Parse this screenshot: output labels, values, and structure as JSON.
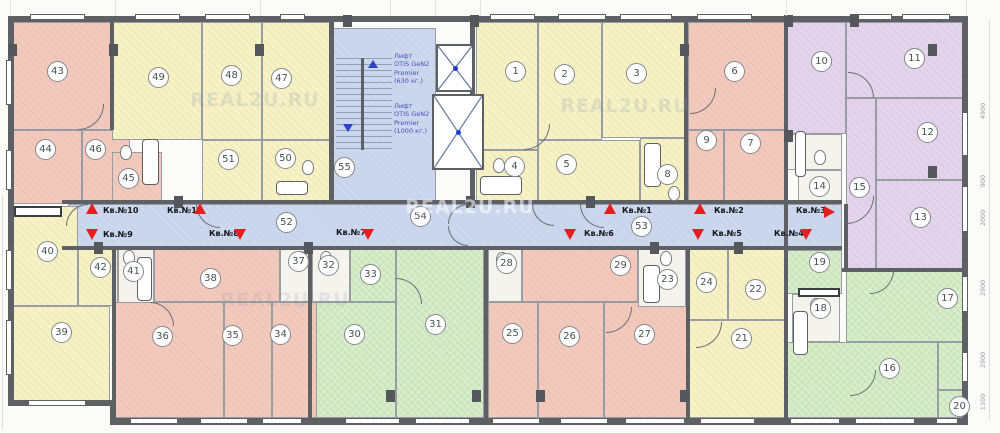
{
  "plan": {
    "width": 1000,
    "height": 433,
    "watermark_text": "REAL2U.RU",
    "colors": {
      "pink": "#f2cabd",
      "yellow": "#f6f2c6",
      "green": "#d9edcb",
      "purple": "#e3d4ec",
      "corridor_blue": "#ccd7ee",
      "bath_white": "#f4f3ec",
      "wall_gray": "#5d6166",
      "arrow_red": "#e31f1f",
      "elevator_text_blue": "#4353b8"
    },
    "rooms": [
      {
        "n": "",
        "x": 68,
        "y": 204,
        "w": 774,
        "h": 46,
        "zone": "corridor"
      },
      {
        "n": "43",
        "x": 12,
        "y": 22,
        "w": 100,
        "h": 108,
        "zone": "pink",
        "lx": 58,
        "ly": 72
      },
      {
        "n": "44",
        "x": 12,
        "y": 130,
        "w": 70,
        "h": 74,
        "zone": "pink",
        "lx": 46,
        "ly": 150
      },
      {
        "n": "46",
        "x": 82,
        "y": 130,
        "w": 48,
        "h": 74,
        "zone": "pink",
        "lx": 96,
        "ly": 150
      },
      {
        "n": "45",
        "x": 112,
        "y": 152,
        "w": 50,
        "h": 52,
        "zone": "pink",
        "lx": 129,
        "ly": 179
      },
      {
        "n": "49",
        "x": 112,
        "y": 22,
        "w": 90,
        "h": 118,
        "zone": "yellow",
        "lx": 159,
        "ly": 78
      },
      {
        "n": "48",
        "x": 202,
        "y": 22,
        "w": 60,
        "h": 118,
        "zone": "yellow",
        "lx": 232,
        "ly": 76
      },
      {
        "n": "47",
        "x": 262,
        "y": 22,
        "w": 68,
        "h": 118,
        "zone": "yellow",
        "lx": 282,
        "ly": 79
      },
      {
        "n": "51",
        "x": 202,
        "y": 140,
        "w": 60,
        "h": 64,
        "zone": "yellow",
        "lx": 229,
        "ly": 160
      },
      {
        "n": "50",
        "x": 262,
        "y": 140,
        "w": 68,
        "h": 64,
        "zone": "yellow",
        "lx": 286,
        "ly": 159
      },
      {
        "n": "55",
        "x": 332,
        "y": 28,
        "w": 104,
        "h": 176,
        "zone": "stair",
        "lx": 345,
        "ly": 168
      },
      {
        "n": "1",
        "x": 476,
        "y": 22,
        "w": 62,
        "h": 128,
        "zone": "yellow",
        "lx": 516,
        "ly": 72
      },
      {
        "n": "2",
        "x": 538,
        "y": 22,
        "w": 64,
        "h": 118,
        "zone": "yellow",
        "lx": 565,
        "ly": 75
      },
      {
        "n": "3",
        "x": 602,
        "y": 22,
        "w": 86,
        "h": 116,
        "zone": "yellow",
        "lx": 637,
        "ly": 74
      },
      {
        "n": "4",
        "x": 476,
        "y": 150,
        "w": 62,
        "h": 54,
        "zone": "yellow",
        "lx": 515,
        "ly": 167
      },
      {
        "n": "5",
        "x": 538,
        "y": 140,
        "w": 102,
        "h": 64,
        "zone": "yellow",
        "lx": 567,
        "ly": 165
      },
      {
        "n": "8",
        "x": 640,
        "y": 138,
        "w": 46,
        "h": 66,
        "zone": "yellow",
        "lx": 668,
        "ly": 175
      },
      {
        "n": "6",
        "x": 688,
        "y": 22,
        "w": 98,
        "h": 108,
        "zone": "pink",
        "lx": 735,
        "ly": 72
      },
      {
        "n": "9",
        "x": 688,
        "y": 130,
        "w": 36,
        "h": 74,
        "zone": "pink",
        "lx": 707,
        "ly": 141
      },
      {
        "n": "7",
        "x": 724,
        "y": 130,
        "w": 62,
        "h": 74,
        "zone": "pink",
        "lx": 751,
        "ly": 144
      },
      {
        "n": "10",
        "x": 786,
        "y": 22,
        "w": 60,
        "h": 112,
        "zone": "purple",
        "lx": 822,
        "ly": 62
      },
      {
        "n": "11",
        "x": 846,
        "y": 22,
        "w": 118,
        "h": 76,
        "zone": "purple",
        "lx": 915,
        "ly": 59
      },
      {
        "n": "12",
        "x": 876,
        "y": 98,
        "w": 88,
        "h": 82,
        "zone": "purple",
        "lx": 928,
        "ly": 133
      },
      {
        "n": "15",
        "x": 846,
        "y": 98,
        "w": 30,
        "h": 172,
        "zone": "purple",
        "lx": 860,
        "ly": 188
      },
      {
        "n": "13",
        "x": 876,
        "y": 180,
        "w": 88,
        "h": 90,
        "zone": "purple",
        "lx": 921,
        "ly": 218
      },
      {
        "n": "14",
        "x": 798,
        "y": 170,
        "w": 44,
        "h": 34,
        "zone": "bath",
        "lx": 820,
        "ly": 187
      },
      {
        "n": "",
        "x": 786,
        "y": 134,
        "w": 56,
        "h": 36,
        "zone": "bath"
      },
      {
        "n": "19",
        "x": 786,
        "y": 250,
        "w": 56,
        "h": 44,
        "zone": "green",
        "lx": 820,
        "ly": 263
      },
      {
        "n": "18",
        "x": 792,
        "y": 294,
        "w": 48,
        "h": 48,
        "zone": "bath",
        "lx": 821,
        "ly": 309
      },
      {
        "n": "17",
        "x": 846,
        "y": 270,
        "w": 118,
        "h": 72,
        "zone": "green",
        "lx": 948,
        "ly": 299
      },
      {
        "n": "16",
        "x": 786,
        "y": 342,
        "w": 152,
        "h": 76,
        "zone": "green",
        "lx": 890,
        "ly": 369
      },
      {
        "n": "20",
        "x": 938,
        "y": 390,
        "w": 26,
        "h": 28,
        "zone": "green",
        "lx": 960,
        "ly": 407
      },
      {
        "n": "",
        "x": 938,
        "y": 342,
        "w": 26,
        "h": 48,
        "zone": "green"
      },
      {
        "n": "40",
        "x": 12,
        "y": 206,
        "w": 66,
        "h": 100,
        "zone": "yellow",
        "lx": 48,
        "ly": 252
      },
      {
        "n": "39",
        "x": 12,
        "y": 306,
        "w": 98,
        "h": 96,
        "zone": "yellow",
        "lx": 62,
        "ly": 333
      },
      {
        "n": "42",
        "x": 78,
        "y": 247,
        "w": 40,
        "h": 59,
        "zone": "yellow",
        "lx": 101,
        "ly": 268
      },
      {
        "n": "41",
        "x": 118,
        "y": 247,
        "w": 36,
        "h": 59,
        "zone": "bath",
        "lx": 134,
        "ly": 272
      },
      {
        "n": "38",
        "x": 154,
        "y": 247,
        "w": 126,
        "h": 55,
        "zone": "pink",
        "lx": 211,
        "ly": 279
      },
      {
        "n": "37",
        "x": 280,
        "y": 247,
        "w": 32,
        "h": 55,
        "zone": "bath",
        "lx": 299,
        "ly": 262
      },
      {
        "n": "36",
        "x": 114,
        "y": 302,
        "w": 110,
        "h": 116,
        "zone": "pink",
        "lx": 163,
        "ly": 337
      },
      {
        "n": "35",
        "x": 224,
        "y": 302,
        "w": 48,
        "h": 116,
        "zone": "pink",
        "lx": 233,
        "ly": 336
      },
      {
        "n": "34",
        "x": 272,
        "y": 302,
        "w": 58,
        "h": 116,
        "zone": "pink",
        "lx": 281,
        "ly": 335
      },
      {
        "n": "32",
        "x": 312,
        "y": 247,
        "w": 38,
        "h": 55,
        "zone": "bath",
        "lx": 329,
        "ly": 266
      },
      {
        "n": "33",
        "x": 350,
        "y": 247,
        "w": 46,
        "h": 55,
        "zone": "green",
        "lx": 371,
        "ly": 275
      },
      {
        "n": "30",
        "x": 316,
        "y": 302,
        "w": 80,
        "h": 116,
        "zone": "green",
        "lx": 355,
        "ly": 335
      },
      {
        "n": "31",
        "x": 396,
        "y": 247,
        "w": 88,
        "h": 171,
        "zone": "green",
        "lx": 436,
        "ly": 325
      },
      {
        "n": "28",
        "x": 488,
        "y": 247,
        "w": 34,
        "h": 55,
        "zone": "bath",
        "lx": 507,
        "ly": 264
      },
      {
        "n": "29",
        "x": 522,
        "y": 247,
        "w": 116,
        "h": 55,
        "zone": "pink",
        "lx": 621,
        "ly": 266
      },
      {
        "n": "25",
        "x": 488,
        "y": 302,
        "w": 50,
        "h": 116,
        "zone": "pink",
        "lx": 513,
        "ly": 334
      },
      {
        "n": "26",
        "x": 538,
        "y": 302,
        "w": 66,
        "h": 116,
        "zone": "pink",
        "lx": 570,
        "ly": 337
      },
      {
        "n": "27",
        "x": 604,
        "y": 302,
        "w": 84,
        "h": 116,
        "zone": "pink",
        "lx": 645,
        "ly": 335
      },
      {
        "n": "23",
        "x": 638,
        "y": 247,
        "w": 48,
        "h": 60,
        "zone": "bath",
        "lx": 668,
        "ly": 280
      },
      {
        "n": "24",
        "x": 686,
        "y": 247,
        "w": 42,
        "h": 73,
        "zone": "yellow",
        "lx": 707,
        "ly": 283
      },
      {
        "n": "22",
        "x": 728,
        "y": 247,
        "w": 60,
        "h": 73,
        "zone": "yellow",
        "lx": 756,
        "ly": 290
      },
      {
        "n": "21",
        "x": 688,
        "y": 320,
        "w": 100,
        "h": 98,
        "zone": "yellow",
        "lx": 742,
        "ly": 339
      }
    ],
    "extra_badges": [
      {
        "n": "52",
        "lx": 287,
        "ly": 223
      },
      {
        "n": "54",
        "lx": 421,
        "ly": 217
      },
      {
        "n": "53",
        "lx": 642,
        "ly": 227
      }
    ],
    "corridor_labels": [
      {
        "t": "Кв.№10",
        "x": 103,
        "y": 206
      },
      {
        "t": "Кв.№11",
        "x": 167,
        "y": 206
      },
      {
        "t": "Кв.№9",
        "x": 103,
        "y": 230
      },
      {
        "t": "Кв.№8",
        "x": 209,
        "y": 229
      },
      {
        "t": "Кв.№7",
        "x": 336,
        "y": 228
      },
      {
        "t": "Кв.№1",
        "x": 622,
        "y": 206
      },
      {
        "t": "Кв.№6",
        "x": 584,
        "y": 229
      },
      {
        "t": "Кв.№2",
        "x": 714,
        "y": 206
      },
      {
        "t": "Кв.№5",
        "x": 712,
        "y": 229
      },
      {
        "t": "Кв.№3",
        "x": 796,
        "y": 206
      },
      {
        "t": "Кв.№4",
        "x": 774,
        "y": 229
      }
    ],
    "triangles": [
      {
        "d": "up",
        "x": 86,
        "y": 203
      },
      {
        "d": "up",
        "x": 194,
        "y": 203
      },
      {
        "d": "down",
        "x": 86,
        "y": 229
      },
      {
        "d": "down",
        "x": 234,
        "y": 229
      },
      {
        "d": "down",
        "x": 362,
        "y": 229
      },
      {
        "d": "up",
        "x": 604,
        "y": 203
      },
      {
        "d": "down",
        "x": 564,
        "y": 229
      },
      {
        "d": "up",
        "x": 694,
        "y": 203
      },
      {
        "d": "down",
        "x": 692,
        "y": 229
      },
      {
        "d": "right",
        "x": 824,
        "y": 206
      },
      {
        "d": "down",
        "x": 800,
        "y": 229
      },
      {
        "d": "down",
        "x": 343,
        "y": 124,
        "c": "#2b43c8",
        "s": 1
      },
      {
        "d": "up",
        "x": 368,
        "y": 60,
        "c": "#2b43c8",
        "s": 1
      }
    ],
    "elevators": [
      {
        "lines": [
          "Лифт",
          "OTIS GeN2",
          "Premier",
          "(630 кг.)"
        ],
        "tx": 394,
        "ty": 52,
        "sx": 436,
        "sy": 44,
        "sw": 38,
        "sh": 48
      },
      {
        "lines": [
          "Лифт",
          "OTIS GeN2",
          "Premier",
          "(1000 кг.)"
        ],
        "tx": 394,
        "ty": 102,
        "sx": 432,
        "sy": 94,
        "sw": 52,
        "sh": 76
      }
    ],
    "stairwell": {
      "x": 336,
      "y": 58,
      "w": 56,
      "h": 92
    },
    "dimensions": [
      {
        "t": "4900",
        "y": 115
      },
      {
        "t": "900",
        "y": 185
      },
      {
        "t": "2000",
        "y": 222
      },
      {
        "t": "2900",
        "y": 292
      },
      {
        "t": "2900",
        "y": 364
      },
      {
        "t": "1200",
        "y": 406
      }
    ],
    "watermarks": [
      {
        "x": 255,
        "y": 100,
        "a": 0.2
      },
      {
        "x": 625,
        "y": 106,
        "a": 0.2
      },
      {
        "x": 285,
        "y": 300,
        "a": 0.16
      },
      {
        "x": 470,
        "y": 207,
        "a": 0.55
      }
    ],
    "walls": [
      [
        8,
        16,
        960,
        6
      ],
      [
        8,
        16,
        6,
        390
      ],
      [
        8,
        400,
        106,
        6
      ],
      [
        110,
        400,
        6,
        24
      ],
      [
        110,
        418,
        858,
        7
      ],
      [
        962,
        16,
        6,
        409
      ],
      [
        110,
        22,
        4,
        108
      ],
      [
        329,
        22,
        5,
        182
      ],
      [
        470,
        22,
        5,
        182
      ],
      [
        684,
        22,
        4,
        182
      ],
      [
        784,
        22,
        4,
        248
      ],
      [
        112,
        247,
        4,
        153
      ],
      [
        308,
        247,
        4,
        171
      ],
      [
        484,
        247,
        4,
        171
      ],
      [
        686,
        247,
        4,
        171
      ],
      [
        784,
        247,
        4,
        171
      ],
      [
        62,
        200,
        780,
        4
      ],
      [
        62,
        246,
        780,
        4
      ],
      [
        844,
        204,
        4,
        66
      ],
      [
        842,
        268,
        126,
        4
      ],
      [
        361,
        58,
        3,
        92
      ]
    ],
    "windows": {
      "top": [
        [
          30,
          55
        ],
        [
          135,
          45
        ],
        [
          205,
          45
        ],
        [
          280,
          25
        ],
        [
          490,
          45
        ],
        [
          558,
          48
        ],
        [
          620,
          52
        ],
        [
          697,
          55
        ],
        [
          850,
          42
        ],
        [
          902,
          48
        ]
      ],
      "bottom_left": [
        [
          28,
          58
        ]
      ],
      "bottom": [
        [
          130,
          48
        ],
        [
          200,
          48
        ],
        [
          262,
          40
        ],
        [
          345,
          55
        ],
        [
          415,
          55
        ],
        [
          492,
          48
        ],
        [
          560,
          48
        ],
        [
          625,
          60
        ],
        [
          700,
          55
        ],
        [
          790,
          50
        ],
        [
          855,
          60
        ],
        [
          936,
          22
        ]
      ],
      "left": [
        [
          60,
          45
        ],
        [
          150,
          40
        ],
        [
          250,
          40
        ],
        [
          320,
          55
        ]
      ],
      "right": [
        [
          112,
          44
        ],
        [
          186,
          46
        ],
        [
          276,
          36
        ],
        [
          352,
          30
        ]
      ]
    },
    "columns": [
      [
        8,
        44
      ],
      [
        109,
        44
      ],
      [
        255,
        44
      ],
      [
        343,
        15
      ],
      [
        680,
        44
      ],
      [
        928,
        44
      ],
      [
        928,
        166
      ],
      [
        784,
        130
      ],
      [
        94,
        242
      ],
      [
        174,
        196
      ],
      [
        304,
        242
      ],
      [
        466,
        196
      ],
      [
        586,
        196
      ],
      [
        650,
        242
      ],
      [
        734,
        242
      ],
      [
        386,
        390
      ],
      [
        472,
        390
      ],
      [
        536,
        390
      ],
      [
        680,
        390
      ],
      [
        850,
        15
      ],
      [
        470,
        15
      ],
      [
        784,
        15
      ]
    ],
    "doors": [
      {
        "v": "tl",
        "x": 66,
        "y": 204,
        "r": 22
      },
      {
        "v": "bl",
        "x": 196,
        "y": 204,
        "r": 24
      },
      {
        "v": "bl",
        "x": 532,
        "y": 204,
        "r": 22
      },
      {
        "v": "bl",
        "x": 580,
        "y": 204,
        "r": 24
      },
      {
        "v": "br",
        "x": 846,
        "y": 196,
        "r": 28
      },
      {
        "v": "br",
        "x": 78,
        "y": 104,
        "r": 26
      },
      {
        "v": "br",
        "x": 524,
        "y": 124,
        "r": 26
      },
      {
        "v": "tr",
        "x": 848,
        "y": 72,
        "r": 26
      },
      {
        "v": "br",
        "x": 870,
        "y": 270,
        "r": 24
      },
      {
        "v": "tr",
        "x": 150,
        "y": 302,
        "r": 24
      },
      {
        "v": "tr",
        "x": 396,
        "y": 278,
        "r": 26
      },
      {
        "v": "br",
        "x": 606,
        "y": 307,
        "r": 26
      },
      {
        "v": "br",
        "x": 850,
        "y": 370,
        "r": 26
      },
      {
        "v": "br",
        "x": 690,
        "y": 88,
        "r": 26
      },
      {
        "v": "br",
        "x": 696,
        "y": 322,
        "r": 26
      },
      {
        "v": "tl",
        "x": 448,
        "y": 204,
        "r": 20
      },
      {
        "v": "bl",
        "x": 448,
        "y": 226,
        "r": 20
      }
    ],
    "fixtures": {
      "tubs": [
        [
          142,
          139,
          17,
          46
        ],
        [
          480,
          176,
          42,
          19
        ],
        [
          644,
          143,
          17,
          44
        ],
        [
          795,
          131,
          11,
          46
        ],
        [
          793,
          311,
          15,
          44
        ],
        [
          643,
          265,
          17,
          38
        ],
        [
          137,
          257,
          15,
          44
        ],
        [
          276,
          181,
          32,
          14
        ]
      ],
      "wcs": [
        [
          120,
          145
        ],
        [
          493,
          158
        ],
        [
          302,
          160
        ],
        [
          668,
          186
        ],
        [
          814,
          150
        ],
        [
          810,
          298
        ],
        [
          123,
          250
        ],
        [
          295,
          251
        ],
        [
          320,
          251
        ],
        [
          496,
          252
        ],
        [
          660,
          251
        ]
      ],
      "counters": [
        [
          14,
          206,
          48,
          11
        ],
        [
          798,
          288,
          42,
          9
        ]
      ]
    },
    "ticks_top": [
      10,
      115,
      260,
      390,
      435,
      480,
      786,
      966
    ]
  }
}
